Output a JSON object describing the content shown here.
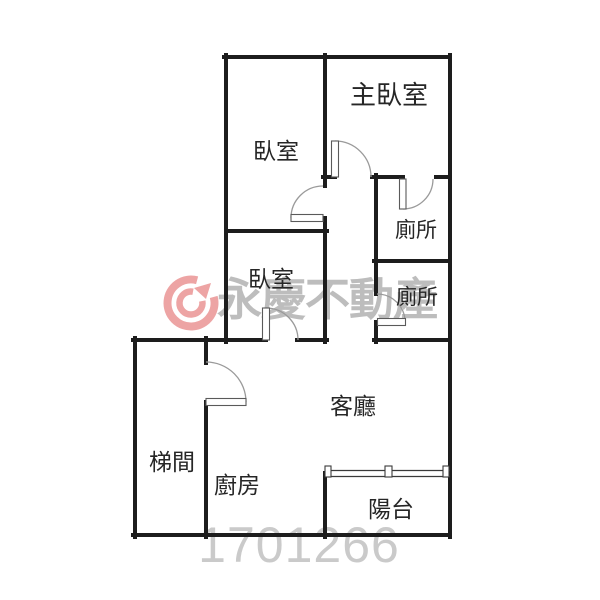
{
  "plan": {
    "type": "floor-plan",
    "background": "#ffffff",
    "wall_color": "#1d1d1d",
    "rooms": [
      {
        "id": "master-bedroom",
        "label": "主臥室"
      },
      {
        "id": "bedroom-1",
        "label": "臥室"
      },
      {
        "id": "bedroom-2",
        "label": "臥室"
      },
      {
        "id": "toilet-1",
        "label": "廁所"
      },
      {
        "id": "toilet-2",
        "label": "廁所"
      },
      {
        "id": "living-room",
        "label": "客廳"
      },
      {
        "id": "stairwell",
        "label": "梯間"
      },
      {
        "id": "kitchen",
        "label": "廚房"
      },
      {
        "id": "balcony",
        "label": "陽台"
      }
    ],
    "watermark": {
      "brand": "永慶不動產",
      "listing_number": "1701266",
      "logo": "yungching-swirl-arrow-logo",
      "brand_color": "#eda4a4",
      "text_color": "#bdbdbd",
      "number_color": "#cacaca"
    }
  }
}
